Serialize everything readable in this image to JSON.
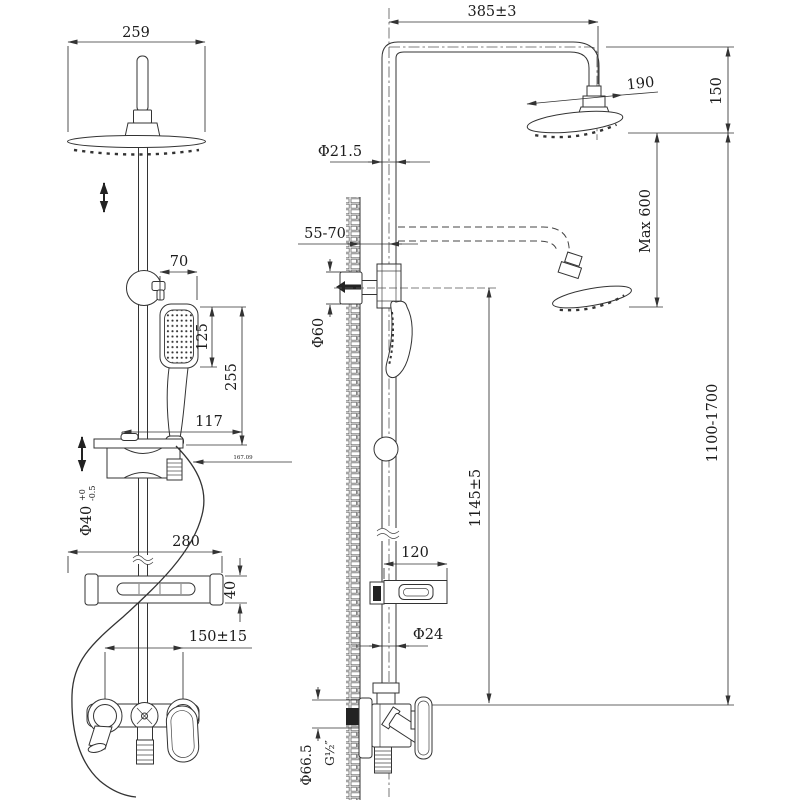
{
  "drawing_title": "shower-column-technical-drawing",
  "colors": {
    "line": "#333333",
    "background": "#ffffff"
  },
  "front_view": {
    "dim_head_width": "259",
    "dim_handset_width": "70",
    "dim_handset_face": "125",
    "dim_handset_length": "255",
    "dim_bracket_width": "117",
    "dim_bracket_note": "167.09",
    "dim_slider_dia": {
      "value": "Φ40",
      "tol_upper": "+0",
      "tol_lower": "-0.5"
    },
    "dim_shelf_width": "280",
    "dim_shelf_height": "40",
    "dim_supply_centers": "150±15"
  },
  "side_view": {
    "dim_arm_reach": "385±3",
    "dim_head_dia": "190",
    "dim_head_drop": "150",
    "dim_max_adjust": "Max 600",
    "dim_pipe_dia": "Φ21.5",
    "dim_wall_distance": "55-70",
    "dim_bracket_dia": "Φ60",
    "dim_overall_height": "1100-1700",
    "dim_bracket_height": "1145±5",
    "dim_shelf_depth": "120",
    "dim_rail_dia": "Φ24",
    "dim_escutcheon_dia": "Φ66.5",
    "dim_thread": "G½″"
  }
}
